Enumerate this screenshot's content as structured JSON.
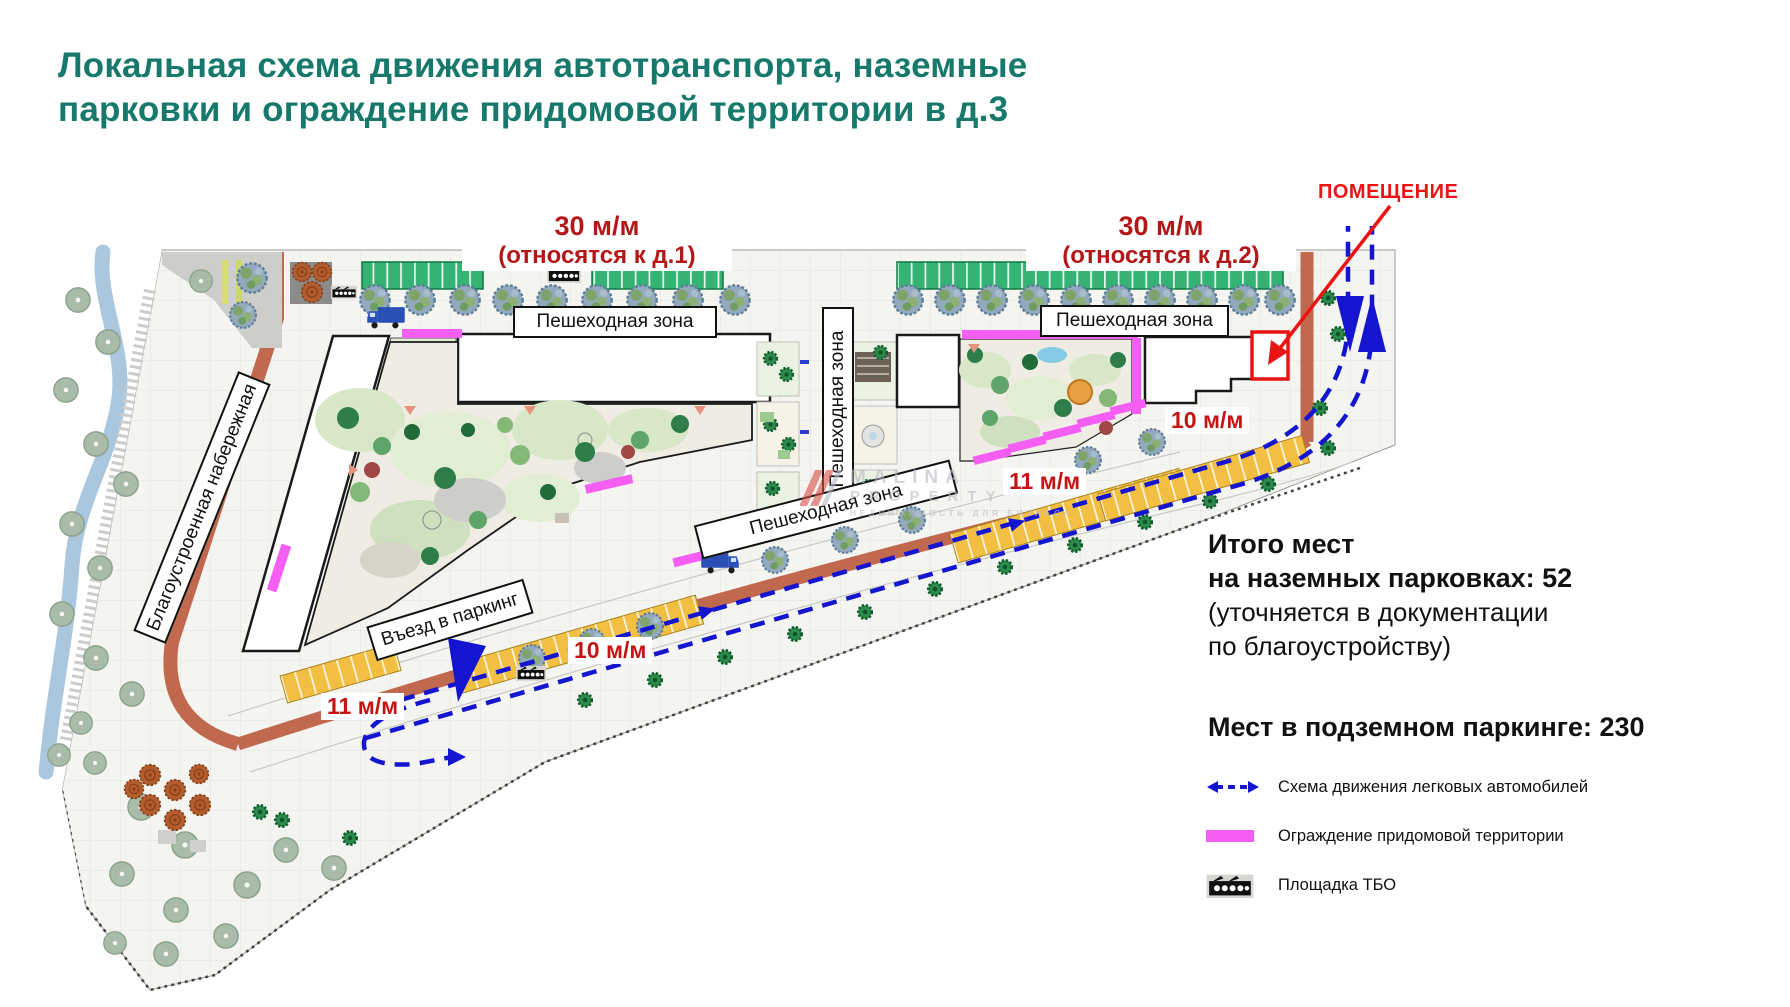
{
  "title": {
    "line1": "Локальная схема движения автотранспорта, наземные",
    "line2": "парковки и ограждение придомовой территории в д.3"
  },
  "plan": {
    "labels": {
      "parking30_1": {
        "value": "30 м/м",
        "note": "(относятся к д.1)"
      },
      "parking30_2": {
        "value": "30 м/м",
        "note": "(относятся к д.2)"
      },
      "pomeshchenie": "ПОМЕЩЕНИЕ",
      "ped_zone": "Пешеходная зона",
      "embankment": "Благоустроенная набережная",
      "parking_entrance": "Въезд в паркинг",
      "cap_10": "10 м/м",
      "cap_11": "11 м/м"
    },
    "watermark": {
      "line1": "MALINA",
      "line2": "PROPERTY",
      "tagline": "НЕДВИЖИМОСТЬ ДЛЯ БИЗНЕСА"
    }
  },
  "summary": {
    "line1": "Итого мест",
    "line2": "на наземных парковках: 52",
    "line3": "(уточняется в документации",
    "line4": "по благоустройству)",
    "underground": "Мест в подземном паркинге: 230"
  },
  "legend": {
    "items": [
      {
        "icon": "car-route-arrow-icon",
        "label": "Схема движения легковых автомобилей"
      },
      {
        "icon": "fence-line-icon",
        "label": "Ограждение придомовой территории"
      },
      {
        "icon": "tbo-pad-icon",
        "label": "Площадка ТБО"
      }
    ]
  },
  "colors": {
    "title_teal": "#17796b",
    "label_dark_red": "#b41717",
    "bright_red": "#ea1414",
    "route_blue": "#1515d0",
    "fence_pink": "#f45ef2",
    "parking_green": "#35b374",
    "parking_yellow": "#f2bf42",
    "road_brown": "#c1694f",
    "river_blue": "#aac7de"
  }
}
